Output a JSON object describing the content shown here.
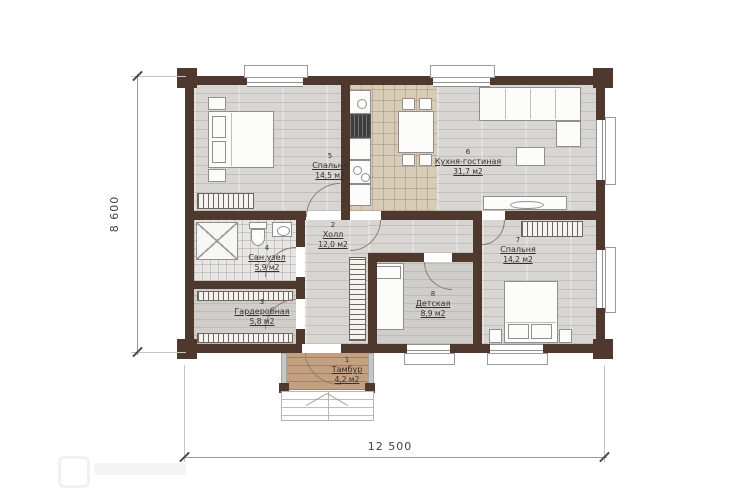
{
  "plan": {
    "type": "floor-plan",
    "units": "mm",
    "overall_width_label": "12 500",
    "overall_height_label": "8 600"
  },
  "colors": {
    "wall": "#4f382d",
    "floor_gray": "#d7d6d3",
    "kitchen_tile": "#d8cbb8",
    "entry_wood": "#c3a081",
    "background": "#ffffff"
  },
  "rooms": [
    {
      "number": "5",
      "name": "Спальня",
      "area": "14,5 м2"
    },
    {
      "number": "6",
      "name": "Кухня-гостиная",
      "area": "31,7 м2"
    },
    {
      "number": "2",
      "name": "Холл",
      "area": "12,0 м2"
    },
    {
      "number": "4",
      "name": "Сан.узел",
      "area": "5,9 м2"
    },
    {
      "number": "3",
      "name": "Гардеробная",
      "area": "5,8 м2"
    },
    {
      "number": "8",
      "name": "Детская",
      "area": "8,9 м2"
    },
    {
      "number": "7",
      "name": "Спальня",
      "area": "14,2 м2"
    },
    {
      "number": "1",
      "name": "Тамбур",
      "area": "4,2 м2"
    }
  ],
  "dimensions": {
    "width": "12 500",
    "height": "8 600"
  },
  "watermark": {
    "present": true,
    "text": ""
  }
}
